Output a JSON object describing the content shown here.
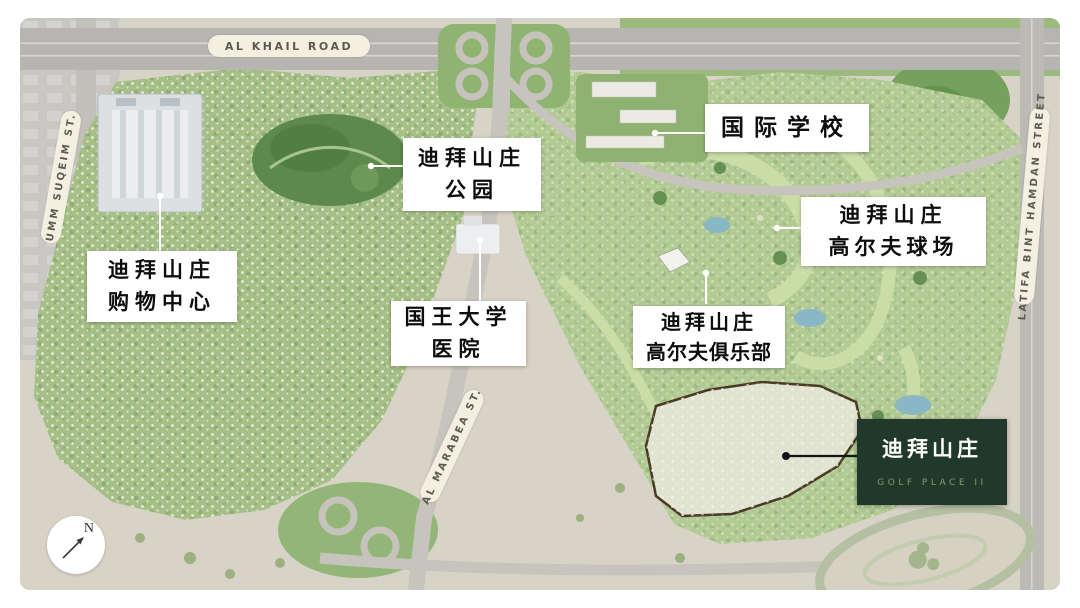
{
  "map": {
    "compass_label": "N",
    "road_labels": {
      "al_khail": "AL KHAIL ROAD",
      "umm_suqeim": "UMM SUQEIM ST.",
      "latifa_bint_hamdan": "LATIFA BINT HAMDAN STREET",
      "al_marabea": "AL MARABEA ST."
    },
    "landmarks": [
      {
        "id": "international-school",
        "line1": "国际学校",
        "line2": ""
      },
      {
        "id": "dubai-hills-park",
        "line1": "迪拜山庄",
        "line2": "公园"
      },
      {
        "id": "dubai-hills-golf-course",
        "line1": "迪拜山庄",
        "line2": "高尔夫球场"
      },
      {
        "id": "dubai-hills-mall",
        "line1": "迪拜山庄",
        "line2": "购物中心"
      },
      {
        "id": "kings-college-hospital",
        "line1": "国王大学",
        "line2": "医院"
      },
      {
        "id": "dubai-hills-golf-club",
        "line1": "迪拜山庄",
        "line2": "高尔夫俱乐部"
      }
    ],
    "project_card": {
      "name": "迪拜山庄",
      "subtitle": "GOLF PLACE II",
      "background": "#20392a",
      "subtitle_color": "#8a9a6e"
    },
    "colors": {
      "sand": "#d8d3c7",
      "community_green": "#a5bf86",
      "golf_green": "#b2ca93",
      "dark_park_green": "#5d8a4c",
      "road_gray": "#b7b5b1",
      "water": "#8ab7c6",
      "label_pill": "#f3f0e2",
      "leader_white": "#ffffff",
      "leader_dark": "#141414"
    }
  }
}
